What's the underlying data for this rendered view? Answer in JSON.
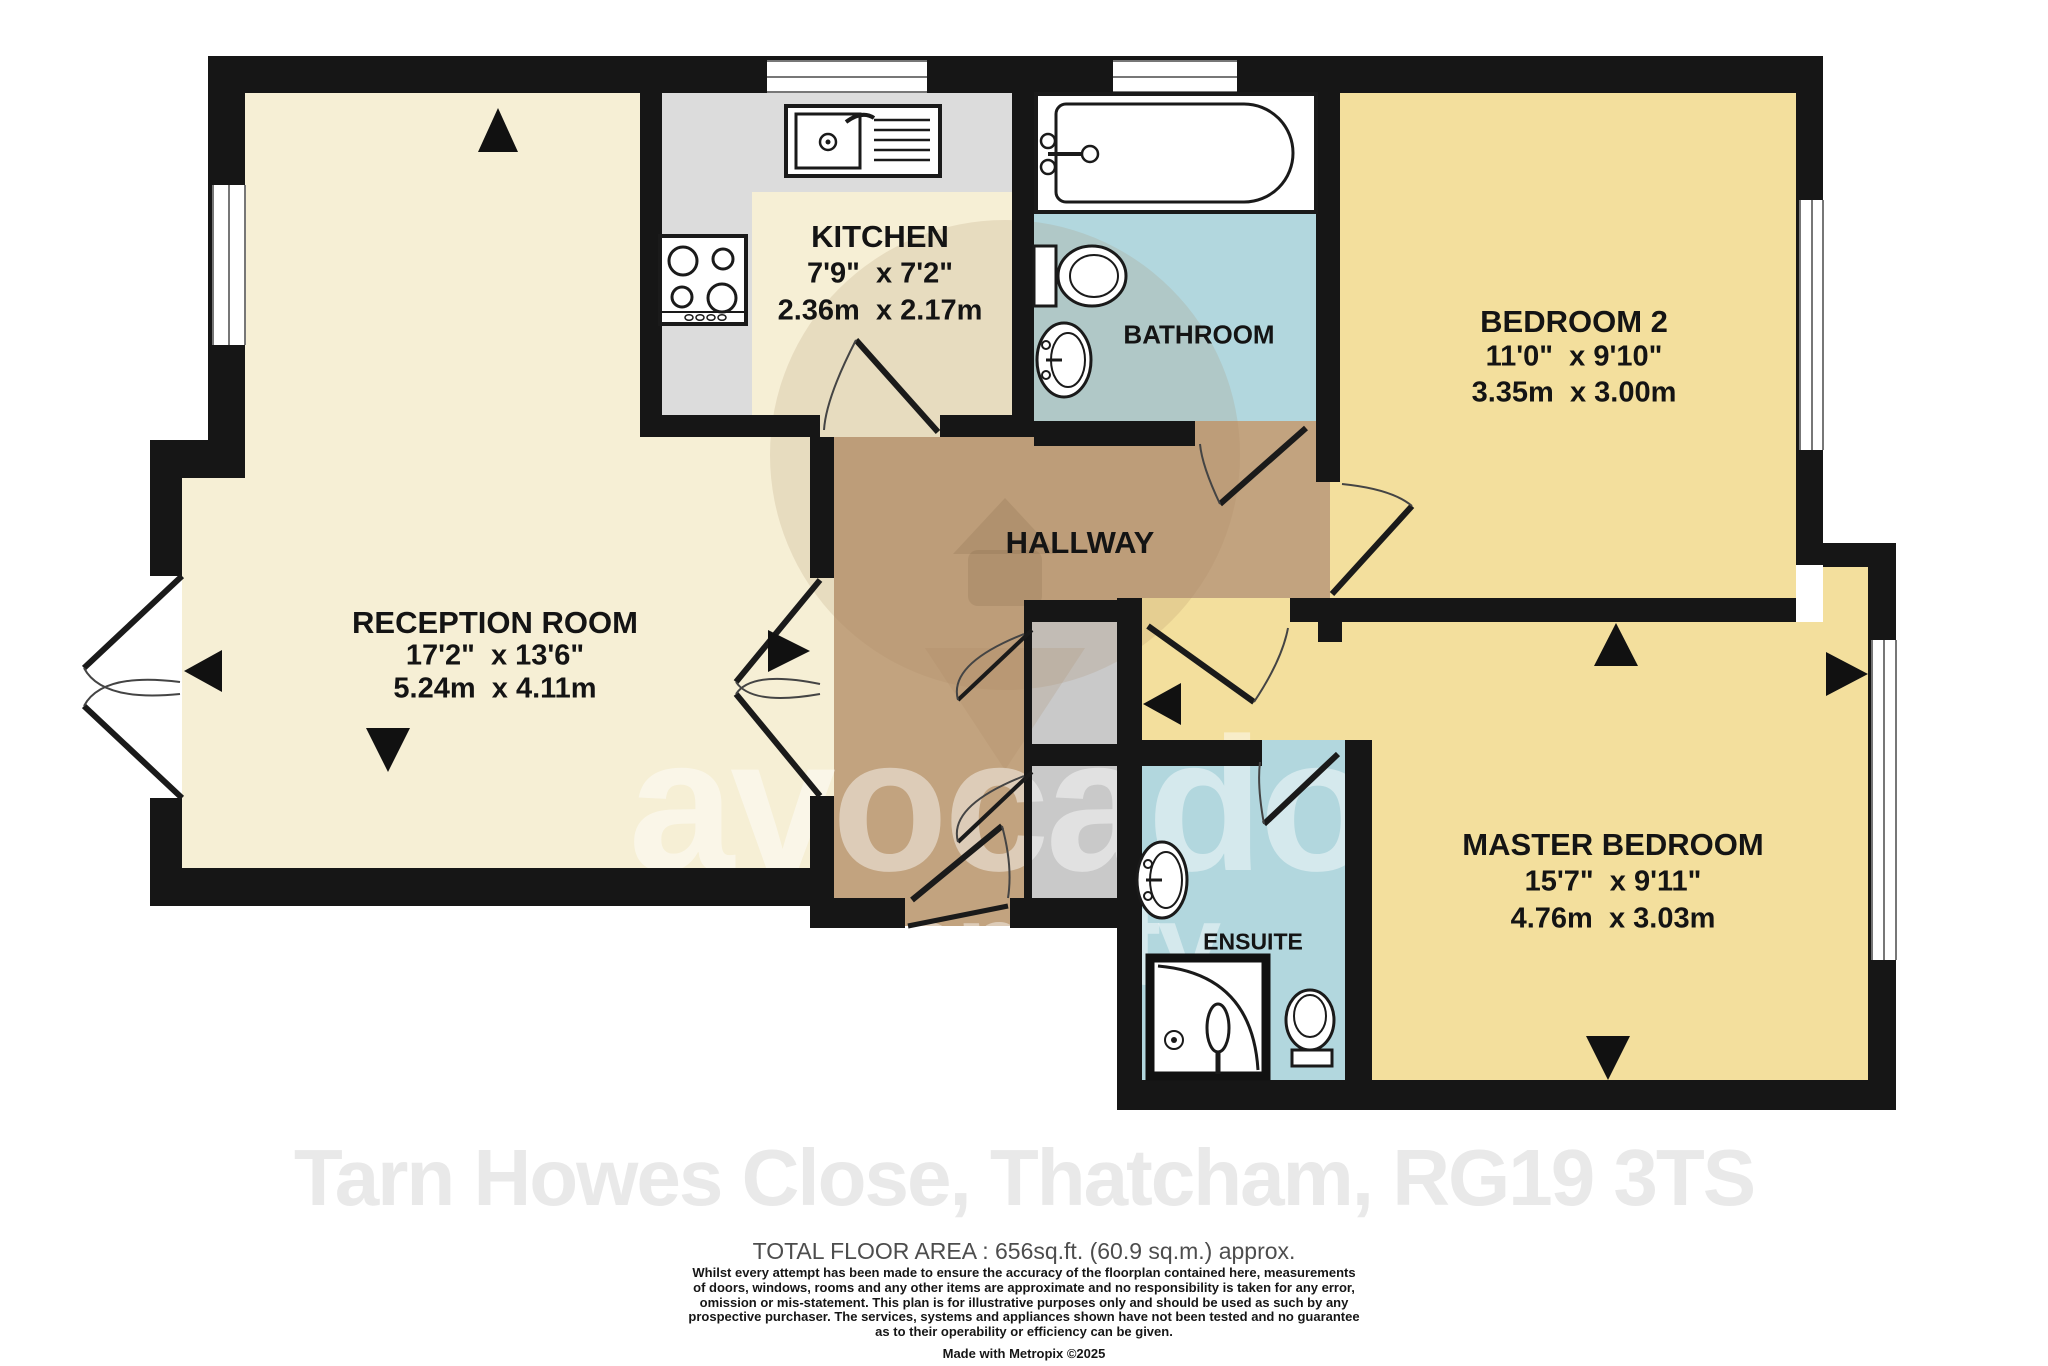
{
  "address": "Tarn Howes Close, Thatcham, RG19 3TS",
  "watermark": {
    "brand_line1": "avocado",
    "brand_line2": "property"
  },
  "rooms": {
    "kitchen": {
      "name": "KITCHEN",
      "imperial": "7'9\"  x 7'2\"",
      "metric": "2.36m  x 2.17m"
    },
    "bathroom": {
      "name": "BATHROOM"
    },
    "bedroom2": {
      "name": "BEDROOM 2",
      "imperial": "11'0\"  x 9'10\"",
      "metric": "3.35m  x 3.00m"
    },
    "hallway": {
      "name": "HALLWAY"
    },
    "reception": {
      "name": "RECEPTION ROOM",
      "imperial": "17'2\"  x 13'6\"",
      "metric": "5.24m  x 4.11m"
    },
    "master": {
      "name": "MASTER BEDROOM",
      "imperial": "15'7\"  x 9'11\"",
      "metric": "4.76m  x 3.03m"
    },
    "ensuite": {
      "name": "ENSUITE"
    }
  },
  "footer": {
    "total_area": "TOTAL FLOOR AREA : 656sq.ft. (60.9 sq.m.) approx.",
    "disclaimer_lines": [
      "Whilst every attempt has been made to ensure the accuracy of the floorplan contained here, measurements",
      "of doors, windows, rooms and any other items are approximate and no responsibility is taken for any error,",
      "omission or mis-statement. This plan is for illustrative purposes only and should be used as such by any",
      "prospective purchaser. The services, systems and appliances shown have not been tested and no guarantee",
      "as to their operability or efficiency can be given."
    ],
    "credit": "Made with Metropix ©2025"
  },
  "colors": {
    "wall": "#161616",
    "reception_floor": "#f6efd5",
    "bedroom_floor": "#f3df9d",
    "bathroom_floor": "#b2d7de",
    "hallway_floor": "#c2a37f",
    "kitchen_counter": "#dcdcdc",
    "cupboard": "#c9c9c9"
  }
}
